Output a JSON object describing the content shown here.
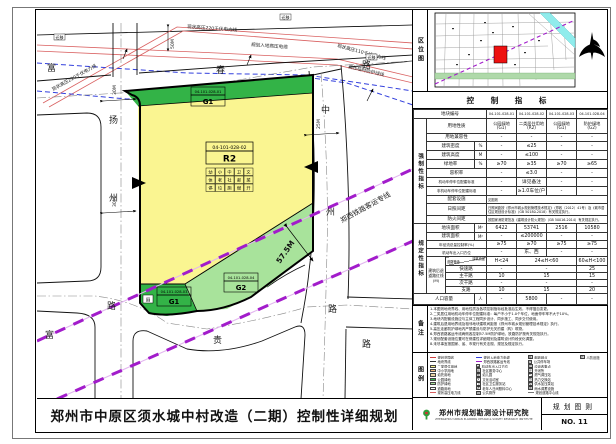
{
  "page": {
    "title": "郑州市中原区须水城中村改造（二期）控制性详细规划",
    "sheet_label": "规划图则",
    "sheet_no": "NO. 11",
    "institute_name": "郑州市规划勘测设计研究院",
    "institute_en": "ZHENGZHOU URBAN PLANNING DESIGN & SURVEY RESEARCH INSTITUTE"
  },
  "location": {
    "label": "区位图"
  },
  "indicators": {
    "title": "控 制 指 标",
    "section_mandatory": "强制性指标",
    "section_prescriptive": "规定性指标",
    "parcel_row_label": "地块编号",
    "parcel_codes": [
      "04-101-028-01",
      "04-101-028-02",
      "04-101-028-03",
      "04-101-028-04"
    ],
    "simple_rows": [
      {
        "label": "用地性质",
        "values": [
          [
            "公园绿地",
            "(G1)"
          ],
          [
            "二类居住用地",
            "(R2)"
          ],
          [
            "公园绿地",
            "(G1)"
          ],
          [
            "防护绿地",
            "(G2)"
          ]
        ],
        "two_line": true
      },
      {
        "label": "用地兼容性",
        "values": [
          "-",
          "-",
          "-",
          "-"
        ]
      },
      {
        "label": "建筑密度",
        "unit": "%",
        "values": [
          "-",
          "≤25",
          "-",
          "-"
        ]
      },
      {
        "label": "建筑高度",
        "unit": "M",
        "values": [
          "-",
          "≤100",
          "-",
          "-"
        ]
      },
      {
        "label": "绿地率",
        "unit": "%",
        "values": [
          "≥70",
          "≥35",
          "≥70",
          "≥65"
        ]
      },
      {
        "label": "容积率",
        "values": [
          "-",
          "≤3.0",
          "-",
          "-"
        ]
      },
      {
        "label": "机动车停车位配建标准",
        "small": true,
        "values": [
          "-",
          "详见备注",
          "-",
          "-"
        ]
      },
      {
        "label": "非机动车停车位配建标准",
        "small": true,
        "values": [
          "-",
          "≥1.0车位/户",
          "-",
          "-"
        ]
      },
      {
        "label": "配套设施",
        "merged": "见图则"
      },
      {
        "label": "日照间距",
        "merged": "日照间距按《郑州市城乡规划管理技术规定》（郑政〔2012〕41号）及《城市居住区规划设计标准》（GB 50180-2018）有关规定执行。"
      },
      {
        "label": "防火间距",
        "merged": "按国家消防规范及《建筑设计防火规范》（GB 50016-2014）有关规定执行。"
      }
    ],
    "presc_rows": [
      {
        "label": "地块面积",
        "unit": "M²",
        "values": [
          "6422",
          "53741",
          "2516",
          "10580"
        ]
      },
      {
        "label": "建筑面积",
        "unit": "M²",
        "values": [
          "-",
          "≤200000",
          "-",
          "-"
        ]
      },
      {
        "label": "年径流总量控制率(%)",
        "values": [
          "≥75",
          "≥70",
          "≥75",
          "≥75"
        ]
      },
      {
        "label": "机动车出入口方位",
        "values": [
          "-",
          "东、西",
          "-",
          "-"
        ]
      }
    ],
    "setback": {
      "label": "建筑后退道路红线(M)",
      "corner_top": "建筑高度",
      "corner_bottom": "道路等级",
      "cols": [
        "H<24",
        "24≤H<60",
        "60≤H<100"
      ],
      "rows": [
        {
          "road": "快速路",
          "values": [
            "-",
            "-",
            "25"
          ]
        },
        {
          "road": "主干路",
          "values": [
            "10",
            "15",
            "15"
          ]
        },
        {
          "road": "次干路",
          "values": [
            "-",
            "-",
            "-"
          ]
        },
        {
          "road": "支路",
          "values": [
            "10",
            "15",
            "20"
          ]
        }
      ]
    },
    "population": {
      "label": "人口容量",
      "unit": "人",
      "values": [
        "-",
        "5800",
        "-",
        "-"
      ]
    }
  },
  "notes": {
    "label": "备注",
    "lines": [
      "1.本图则地块界线、用地性质及各项控制指标经批准后生效，不得擅自变更。",
      "2.二类居住用地机动车停车位配建标准：每户不小于1.0个车位，地面停车率不大于10%。",
      "3.地块内配套设施应与主体工程同步设计、同步施工、同步交付使用。",
      "4.建筑后退用地界线及相邻地块建筑间距按《郑州市城乡规划管理技术规定》执行。",
      "5.高压走廊防护绿地内严禁建设与防护无关的建（构）筑物。",
      "6.郑西铁路客运专线两侧各控制57.5M防护绿地，铁路防护按有关规范执行。",
      "7.规划配套设施位置可在修建性详细规划及建筑设计阶段优化调整。",
      "8.未尽事宜按国家、省、市现行有关法规、规范及规定执行。"
    ]
  },
  "legend": {
    "label": "图例",
    "col1": [
      {
        "t": "规划范围线",
        "s": "dash",
        "c": "#D04040"
      },
      {
        "t": "地块界线",
        "s": "line",
        "c": "#333333"
      },
      {
        "t": "二类居住用地",
        "s": "fill",
        "c": "#FAF591"
      },
      {
        "t": "中小学用地",
        "s": "fill",
        "c": "#F2B97E"
      },
      {
        "t": "幼托用地",
        "s": "fill",
        "c": "#E9D3A4"
      },
      {
        "t": "公园绿地",
        "s": "fill",
        "c": "#33B347"
      },
      {
        "t": "防护绿地",
        "s": "fill",
        "c": "#A8E39B"
      },
      {
        "t": "道路用地",
        "s": "fill",
        "c": "#FFFFFF"
      },
      {
        "t": "现状高压电力线",
        "s": "line",
        "c": "#D96060"
      }
    ],
    "col2": [
      {
        "t": "规划入地电力电缆",
        "s": "dash",
        "c": "#3340DD"
      },
      {
        "t": "郑西铁路客运专线",
        "s": "dash",
        "c": "#A21CCB"
      },
      {
        "t": "机动车出入口方位",
        "s": "box",
        "g": "▲"
      },
      {
        "t": "社区服务中心",
        "s": "box",
        "g": "服"
      },
      {
        "t": "幼儿园",
        "s": "box",
        "g": "幼"
      },
      {
        "t": "文化活动室",
        "s": "box",
        "g": "文"
      },
      {
        "t": "社区卫生服务站",
        "s": "box",
        "g": "卫"
      },
      {
        "t": "老年人日间照料中心",
        "s": "box",
        "g": "老"
      },
      {
        "t": "公共厕所",
        "s": "box",
        "g": "厕"
      }
    ],
    "col3": [
      {
        "t": "邮政网点",
        "s": "box",
        "g": "邮"
      },
      {
        "t": "公共停车场",
        "s": "box",
        "g": "P"
      },
      {
        "t": "垃圾收集点",
        "s": "box",
        "g": "垃"
      },
      {
        "t": "开闭所",
        "s": "box",
        "g": "开"
      },
      {
        "t": "燃气调压站",
        "s": "box",
        "g": "气"
      },
      {
        "t": "热力交换站",
        "s": "box",
        "g": "热"
      },
      {
        "t": "供水加压泵站",
        "s": "box",
        "g": "泵"
      },
      {
        "t": "雨水调蓄设施",
        "s": "box",
        "g": "雨"
      },
      {
        "t": "规划道路中心线",
        "s": "dashdot",
        "c": "#777777"
      }
    ],
    "col4": [
      {
        "t": "人防设施",
        "s": "box",
        "g": "防"
      }
    ]
  },
  "map": {
    "roads": {
      "top": "富春路",
      "left": "扬州路",
      "right": "中州路",
      "bottom": "富贵路"
    },
    "power_labels": {
      "left": "现状高压220千伏电力线",
      "top": "现状高压220千伏电力线",
      "cable": "规划入地高压电缆",
      "right": "现状高压110千伏电力线",
      "protect": "高压临时防护绿线",
      "relocate": "迁移"
    },
    "railway_label": "郑西铁路客运专线",
    "dims": {
      "corridor": "57.5M",
      "left_road": "30M",
      "right_road": "25M",
      "top": "50M"
    },
    "parcels": {
      "r2": {
        "code": "04-101-028-02",
        "use": "R2"
      },
      "g1_top": {
        "code": "04-101-028-01",
        "use": "G1"
      },
      "g1_bottom": {
        "code": "04-101-028-03",
        "use": "G1"
      },
      "g2": {
        "code": "04-101-028-04",
        "use": "G2"
      }
    },
    "facility_grid": [
      "幼",
      "小",
      "中",
      "卫",
      "文",
      "体",
      "老",
      "社",
      "邮",
      "菜",
      "停",
      "垃",
      "厕",
      "燃",
      "开"
    ],
    "toilet_icon": "厕"
  },
  "colors": {
    "residential": "#FAF591",
    "park_green": "#33B347",
    "protect_green": "#A8E39B",
    "railway_purple": "#A21CCB",
    "power_red": "#D96060",
    "cable_blue": "#3340DD",
    "parcel_red": "#EE1111",
    "river_cyan": "#90ECEC"
  }
}
